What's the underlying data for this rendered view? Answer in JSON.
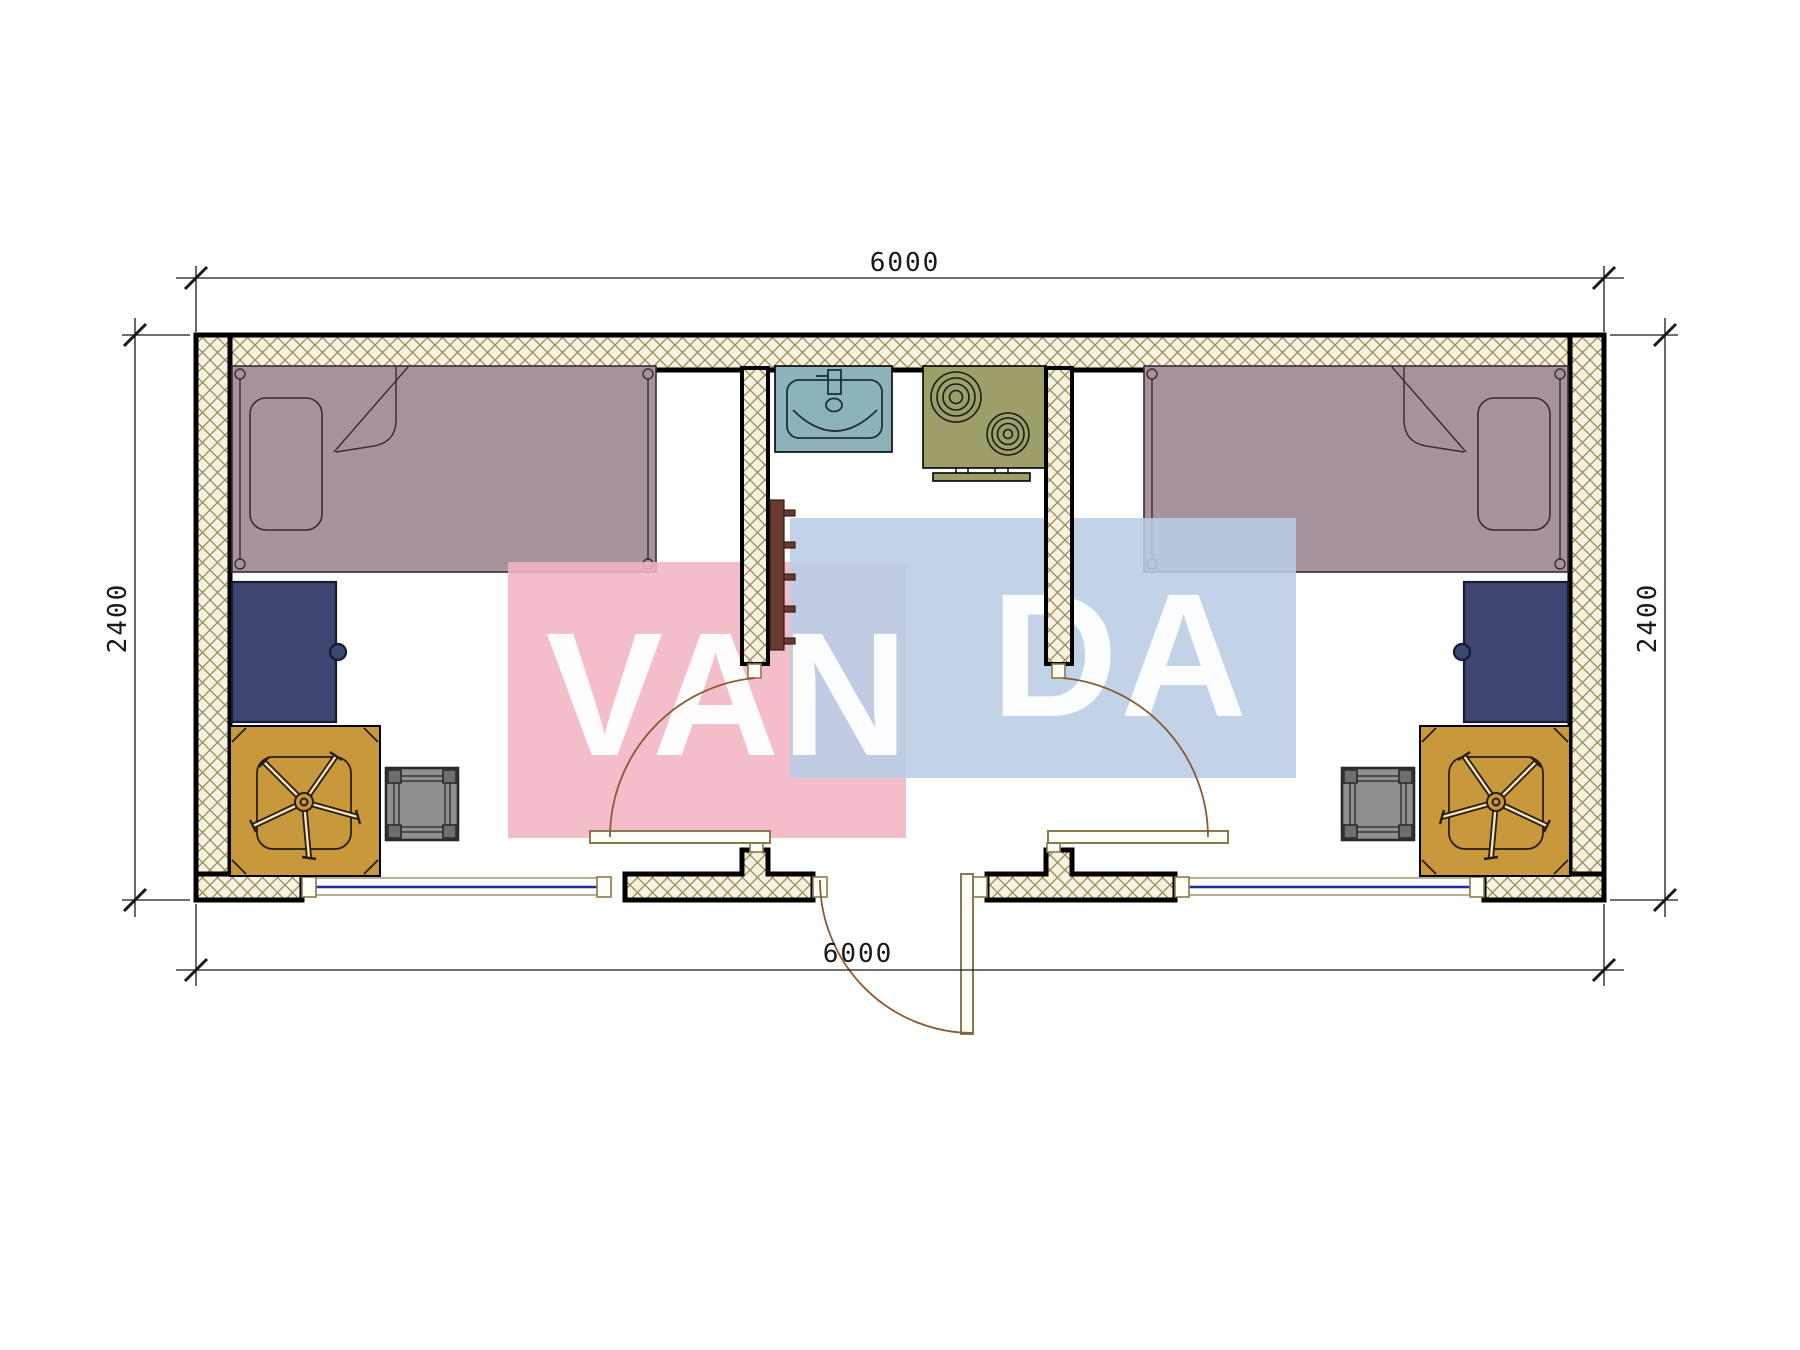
{
  "drawing": {
    "type": "architectural-floor-plan",
    "dimensions": {
      "top_width": "6000",
      "bottom_width": "6000",
      "left_height": "2400",
      "right_height": "2400"
    },
    "watermark": {
      "text_full": "VANDA",
      "part1": "VAN",
      "part2": "DA"
    },
    "furniture": [
      "bed-left",
      "pillow-left",
      "desk-left",
      "office-chair-left",
      "stool-left",
      "sink",
      "stove",
      "coat-rack",
      "bed-right",
      "pillow-right",
      "desk-right",
      "office-chair-right",
      "stool-right"
    ],
    "openings": [
      "window-left",
      "window-right",
      "entrance-door",
      "room-left-interior-door",
      "room-right-interior-door"
    ]
  },
  "colors": {
    "wall-bg": "#f7f1df",
    "hatch-line": "#998a58",
    "bed": "#a8929e",
    "bed-line": "#3a2a35",
    "desk": "#3f4670",
    "desk-line": "#161b33",
    "chair": "#c8993c",
    "chair-line": "#2a1d0d",
    "stool": "#8f8f8f",
    "stool-line": "#2a2a2a",
    "sink": "#8cb3ba",
    "stove": "#9e9e6a",
    "fixture-line": "#1c3038",
    "rack": "#6b3a2f",
    "door": "#8a7a50",
    "arc": "#8a5a35",
    "window-line": "#1f2d9e",
    "dim": "#1a1a1a",
    "wm-pink": "#f2b4c3",
    "wm-blue": "#b9cde4",
    "wm-text": "#ffffff"
  }
}
